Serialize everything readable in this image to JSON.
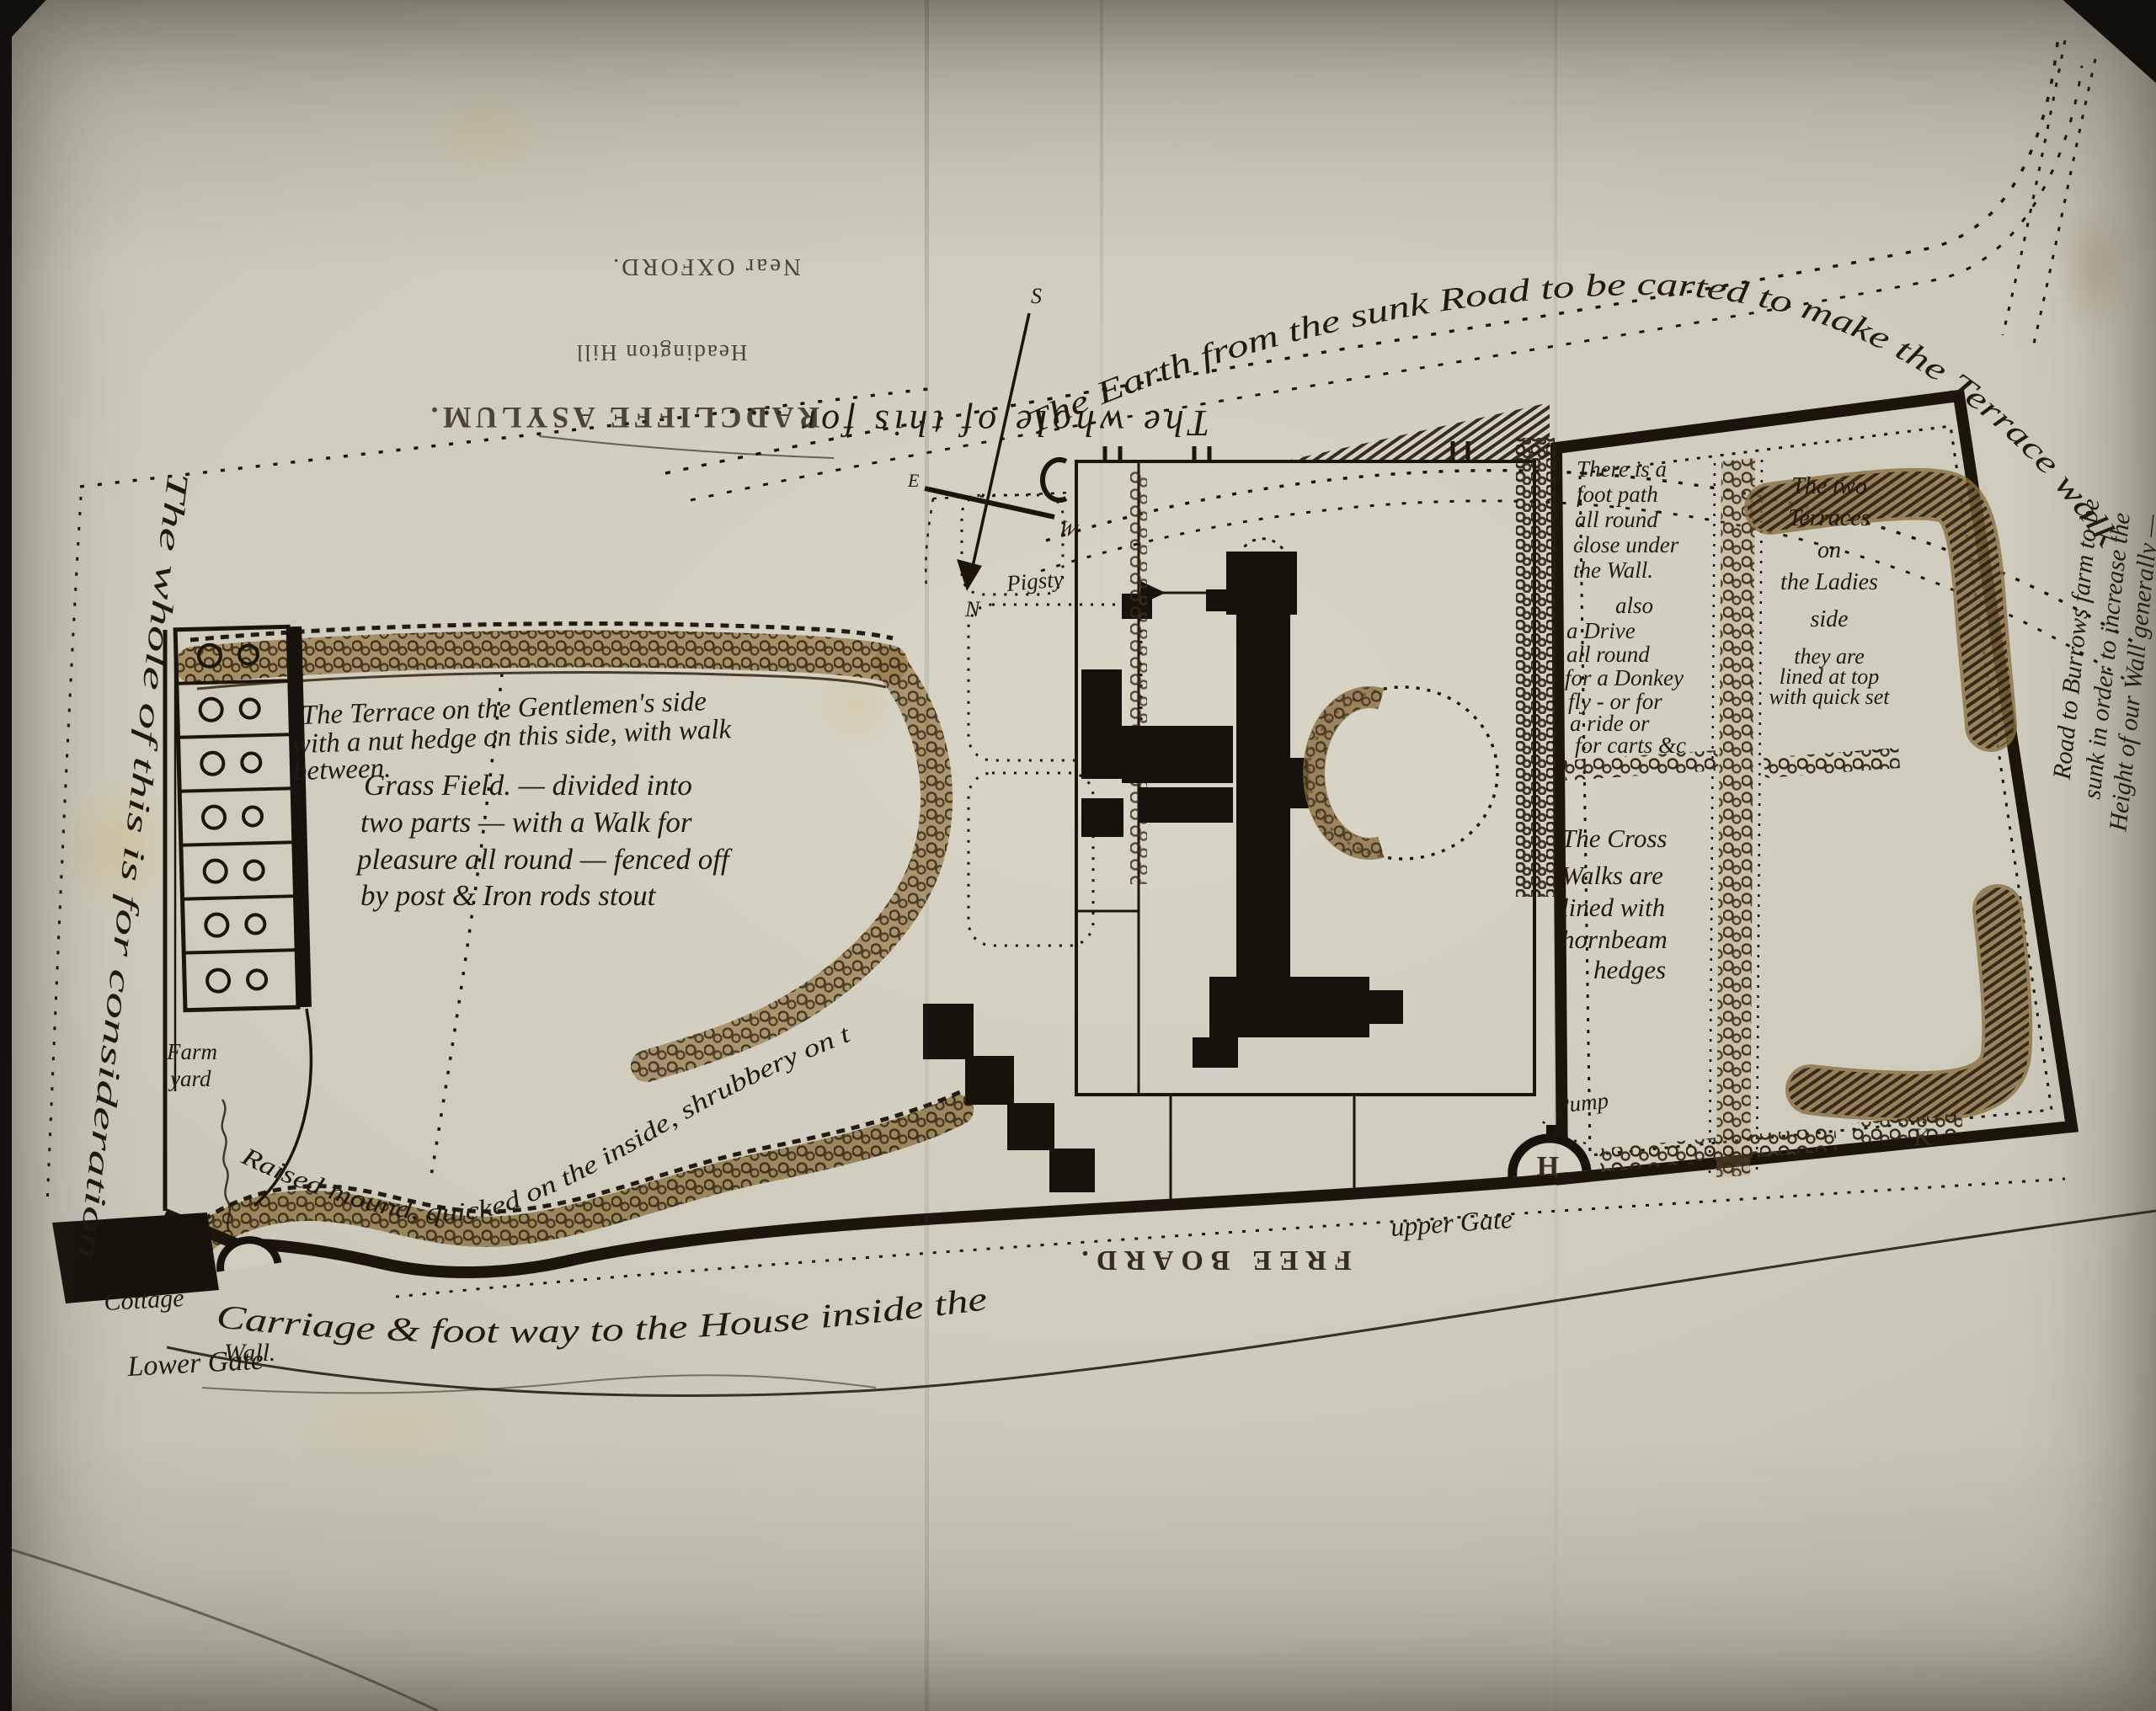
{
  "photo": {
    "paper": "#cdcabc",
    "ink": "#1b150c",
    "wash": "#8f7444"
  },
  "printed": {
    "title": "RADCLIFFE ASYLUM.",
    "subtitle": "Headington Hill",
    "location": "Near OXFORD.",
    "free_board": "FREE BOARD."
  },
  "compass": {
    "n": "N",
    "s": "S",
    "e": "E",
    "w": "W"
  },
  "notes": {
    "sunk_road": "The Earth from the sunk Road to be carted to make the Terrace walk",
    "upside_down": "The whole of this for …",
    "left_margin": "The whole of this is for consideration",
    "gentlemens": [
      "The Terrace on the Gentlemen's side",
      "with a nut hedge on this side, with walk",
      "between."
    ],
    "grass_field": [
      "Grass Field. — divided into",
      "two parts — with a Walk for",
      "pleasure all round — fenced off",
      "by post & Iron rods stout"
    ],
    "foot_path": [
      "There is a",
      "foot path",
      "all round",
      "close under",
      "the Wall.",
      "also",
      "a Drive",
      "all round",
      "for a Donkey",
      "fly - or for",
      "a ride or",
      "for carts &c"
    ],
    "ladies": [
      "The two",
      "Terraces",
      "on",
      "the Ladies",
      "side",
      "they are",
      "lined at top",
      "with quick set"
    ],
    "cross_walks": [
      "The Cross",
      "Walks are",
      "lined with",
      "hornbeam",
      "hedges"
    ],
    "raised_mound": "Raised mound, quicked on the inside, shrubbery on the out",
    "carriage_way": "Carriage & foot way to the House inside the",
    "wall": "Wall.",
    "right_margin": [
      "Road to Burrows farm to be",
      "sunk in order to increase the",
      "Height of our Wall generally —"
    ]
  },
  "labels": {
    "pigsty": "Pigsty",
    "farm": "Farm",
    "yard": "yard",
    "cottage": "Cottage",
    "lower_gate": "Lower Gate",
    "upper_gate": "upper Gate",
    "pump": "Pump",
    "gate_h": "H",
    "corner_k": "K"
  }
}
